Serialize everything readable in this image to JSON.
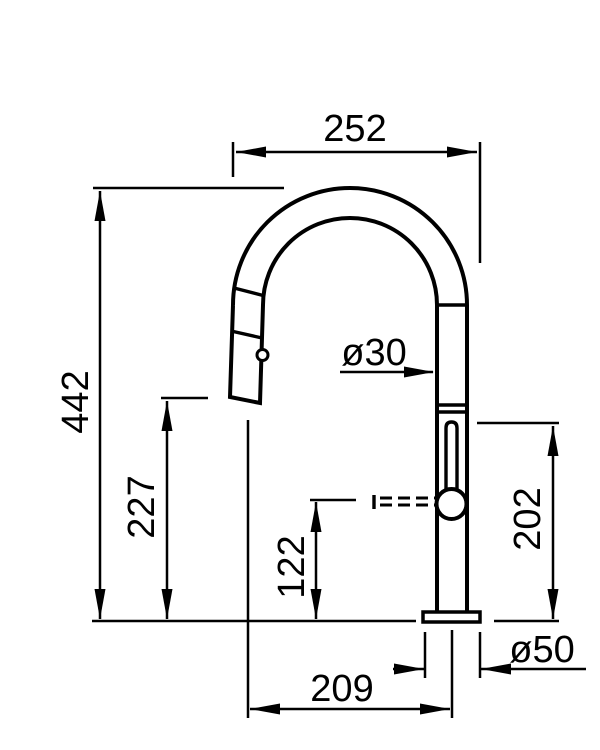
{
  "diagram": {
    "type": "technical-drawing",
    "colors": {
      "ink": "#000000",
      "background": "#ffffff"
    },
    "dimensions": {
      "width_top": {
        "label": "252"
      },
      "height_total": {
        "label": "442"
      },
      "height_spout": {
        "label": "227"
      },
      "height_hose": {
        "label": "122"
      },
      "height_body": {
        "label": "202"
      },
      "reach_bottom": {
        "label": "209"
      },
      "pipe_diameter": {
        "label": "ø30"
      },
      "base_diameter": {
        "label": "ø50"
      }
    }
  }
}
